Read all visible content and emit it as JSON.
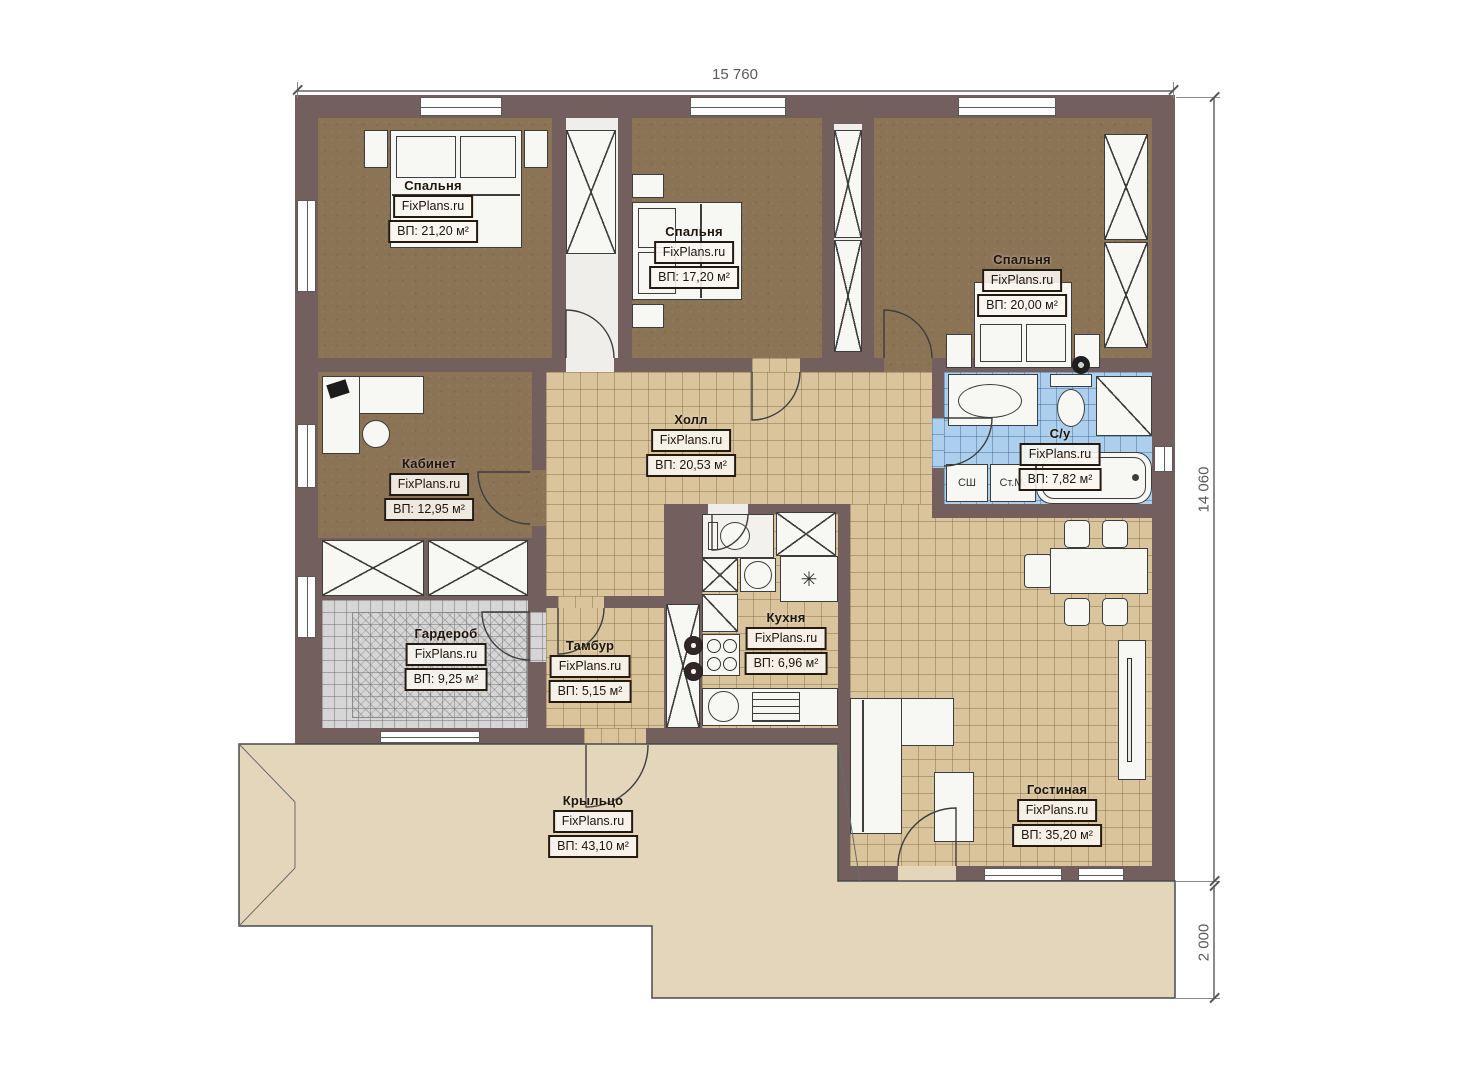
{
  "brand": "FixPlans.ru",
  "dimensions": {
    "width_top": "15 760",
    "height_right": "14 060",
    "porch_right": "2 000"
  },
  "rooms": [
    {
      "name": "Спальня",
      "brand": "FixPlans.ru",
      "area": "ВП: 21,20 м²"
    },
    {
      "name": "Спальня",
      "brand": "FixPlans.ru",
      "area": "ВП: 17,20 м²"
    },
    {
      "name": "Спальня",
      "brand": "FixPlans.ru",
      "area": "ВП: 20,00 м²"
    },
    {
      "name": "Кабинет",
      "brand": "FixPlans.ru",
      "area": "ВП: 12,95 м²"
    },
    {
      "name": "Холл",
      "brand": "FixPlans.ru",
      "area": "ВП: 20,53 м²"
    },
    {
      "name": "С/у",
      "brand": "FixPlans.ru",
      "area": "ВП: 7,82 м²"
    },
    {
      "name": "Гардероб",
      "brand": "FixPlans.ru",
      "area": "ВП: 9,25 м²"
    },
    {
      "name": "Тамбур",
      "brand": "FixPlans.ru",
      "area": "ВП: 5,15 м²"
    },
    {
      "name": "Кухня",
      "brand": "FixPlans.ru",
      "area": "ВП: 6,96 м²"
    },
    {
      "name": "Гостиная",
      "brand": "FixPlans.ru",
      "area": "ВП: 35,20 м²"
    },
    {
      "name": "Крыльцо",
      "brand": "FixPlans.ru",
      "area": "ВП: 43,10 м²"
    }
  ],
  "appliances": {
    "dryer_label": "СШ",
    "washer_label": "Ст.М."
  },
  "icons": {
    "fridge_glyph": "✳"
  },
  "colors": {
    "wall": "#745f5f",
    "floor_wood": "#8b7356",
    "tile_beige": "#d9c49c",
    "tile_blue": "#abcfed",
    "tile_grey": "#d6d6d6",
    "porch": "#e4d6ba"
  }
}
